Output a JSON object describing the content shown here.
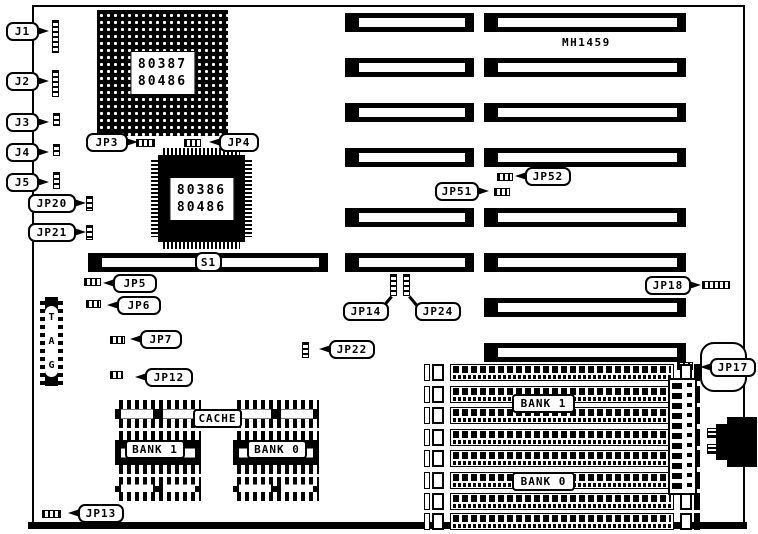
{
  "diagram": {
    "model": "MH1459",
    "colors": {
      "ink": "#000000",
      "paper": "#ffffff"
    },
    "fpu_socket": {
      "line1": "80387",
      "line2": "80486"
    },
    "cpu_chip": {
      "line1": "80386",
      "line2": "80486"
    },
    "tag_socket": {
      "letters": [
        "T",
        "A",
        "G"
      ]
    },
    "cache": {
      "title": "CACHE",
      "bank1": "BANK 1",
      "bank0": "BANK 0"
    },
    "simm": {
      "bank1": "BANK 1",
      "bank0": "BANK 0"
    },
    "callouts": {
      "j1": "J1",
      "j2": "J2",
      "j3": "J3",
      "j4": "J4",
      "j5": "J5",
      "jp3": "JP3",
      "jp4": "JP4",
      "jp5": "JP5",
      "jp6": "JP6",
      "jp7": "JP7",
      "jp12": "JP12",
      "jp13": "JP13",
      "jp14": "JP14",
      "jp17": "JP17",
      "jp18": "JP18",
      "jp20": "JP20",
      "jp21": "JP21",
      "jp22": "JP22",
      "jp24": "JP24",
      "jp51": "JP51",
      "jp52": "JP52",
      "s1": "S1"
    }
  }
}
